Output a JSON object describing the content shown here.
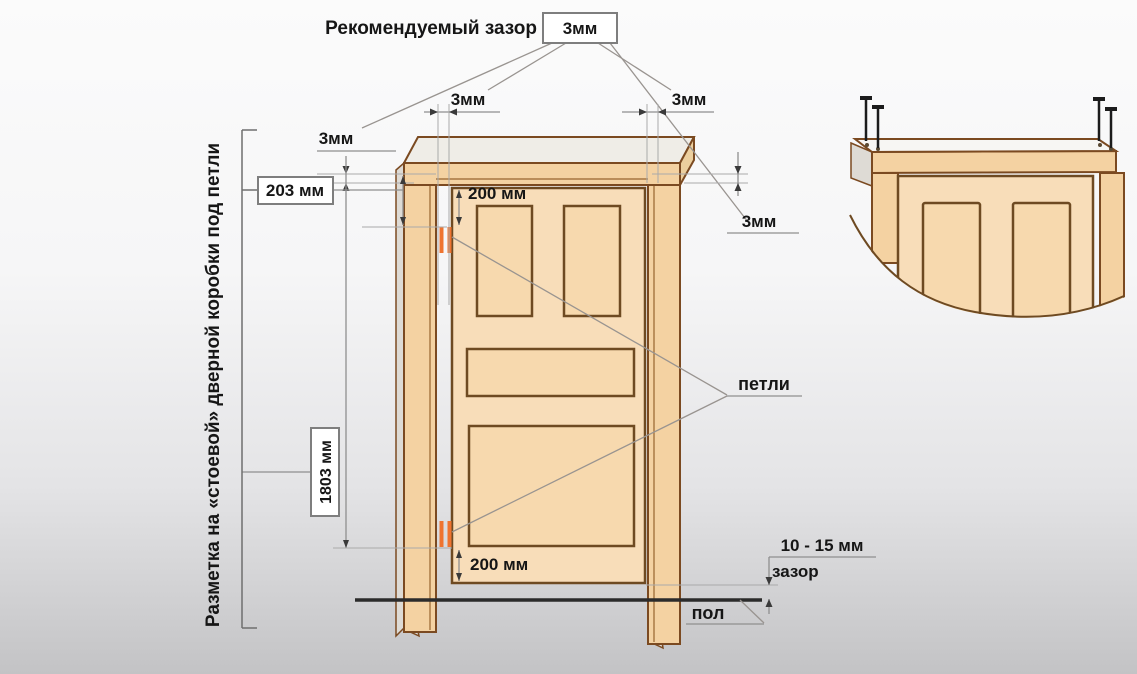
{
  "header": {
    "title": "Рекомендуемый зазор",
    "gap_box": "3мм"
  },
  "dimension_labels": {
    "gap_left_outer": "3мм",
    "gap_left_top": "3мм",
    "gap_right_top": "3мм",
    "gap_right_side": "3мм",
    "hinge_top_offset": "203 мм",
    "hinge_top_inset": "200 мм",
    "hinge_bottom_inset": "200 мм",
    "hinge_span": "1803 мм",
    "hinges": "петли",
    "floor_gap_value": "10 - 15 мм",
    "floor_gap_word": "зазор",
    "floor": "пол"
  },
  "side_note": "Разметка на «стоевой» дверной коробки под петли",
  "colors": {
    "wood_fill": "#f4d2a2",
    "wood_light_fill": "#f8ddb9",
    "wood_outline": "#7b4a21",
    "hinge_accent": "#ef7430",
    "dimension_line": "#8f8f8f",
    "floor_line": "#2b2b2b",
    "text": "#161616",
    "background_top": "#fbfbfb",
    "background_bottom": "#c3c3c5"
  }
}
